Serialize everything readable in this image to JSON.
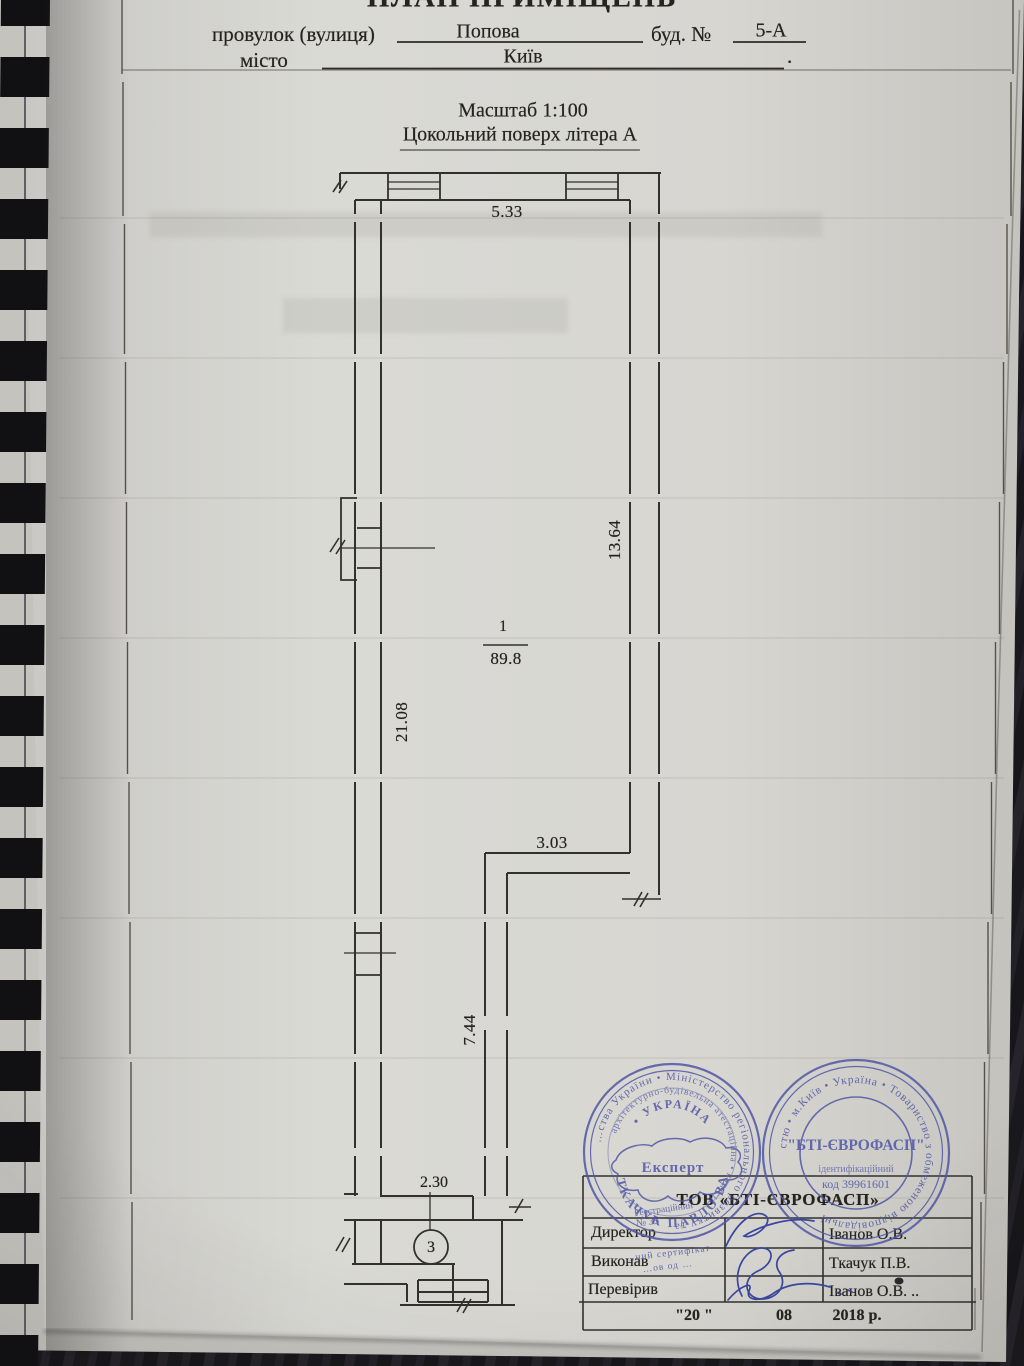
{
  "colors": {
    "stamp_ink": "#4f56a5",
    "line_ink": "#33312d",
    "paper": "#d8d7d2"
  },
  "page": {
    "title": "ПЛАН ПРИМІЩЕНЬ",
    "form": {
      "street_label": "провулок (вулиця)",
      "street_value": "Попова",
      "house_label": "буд. №",
      "house_value": "5-А",
      "city_label": "місто",
      "city_value": "Київ",
      "city_end": ".",
      "scale": "Масштаб  1:100",
      "floor": "Цокольний поверх літера А"
    }
  },
  "plan": {
    "room": {
      "number": "1",
      "area": "89.8"
    },
    "room3": "3",
    "dims": {
      "top": "5.33",
      "right": "13.64",
      "left": "21.08",
      "step": "3.03",
      "lower": "7.44",
      "bottom": "2.30"
    }
  },
  "stamps": {
    "expert": {
      "ring1": "…ства України  •  Міністерство регіонального розвитку та",
      "ring2": "архітектурно-будівельна атестаційна • комісія",
      "country_arc": "•  УКРАЇНА  •",
      "center": "Експерт",
      "reg1": "Реєстраційний",
      "reg2": "№ 35",
      "name_arc": "ТКАЧУК  ПАВЛО  ВА",
      "cert1": "…ний сертифікат",
      "cert2": "…ов од …"
    },
    "bti": {
      "ring": "стю • м.Київ • Україна • Товариство з обмеженою відповідальні",
      "center": "\"БТІ-ЄВРОФАСП\"",
      "line2": "ідентифікаційний",
      "line3": "код 39961601"
    }
  },
  "table": {
    "company": "ТОВ «БТІ-ЄВРОФАСП»",
    "rows": [
      {
        "label": "Директор",
        "name": "Іванов О.В."
      },
      {
        "label": "Виконав",
        "name": "Ткачук П.В."
      },
      {
        "label": "Перевірив",
        "name": "Іванов О.В. .."
      }
    ],
    "date_day": "\"20  \"",
    "date_month": "08",
    "date_year": "2018 р."
  }
}
